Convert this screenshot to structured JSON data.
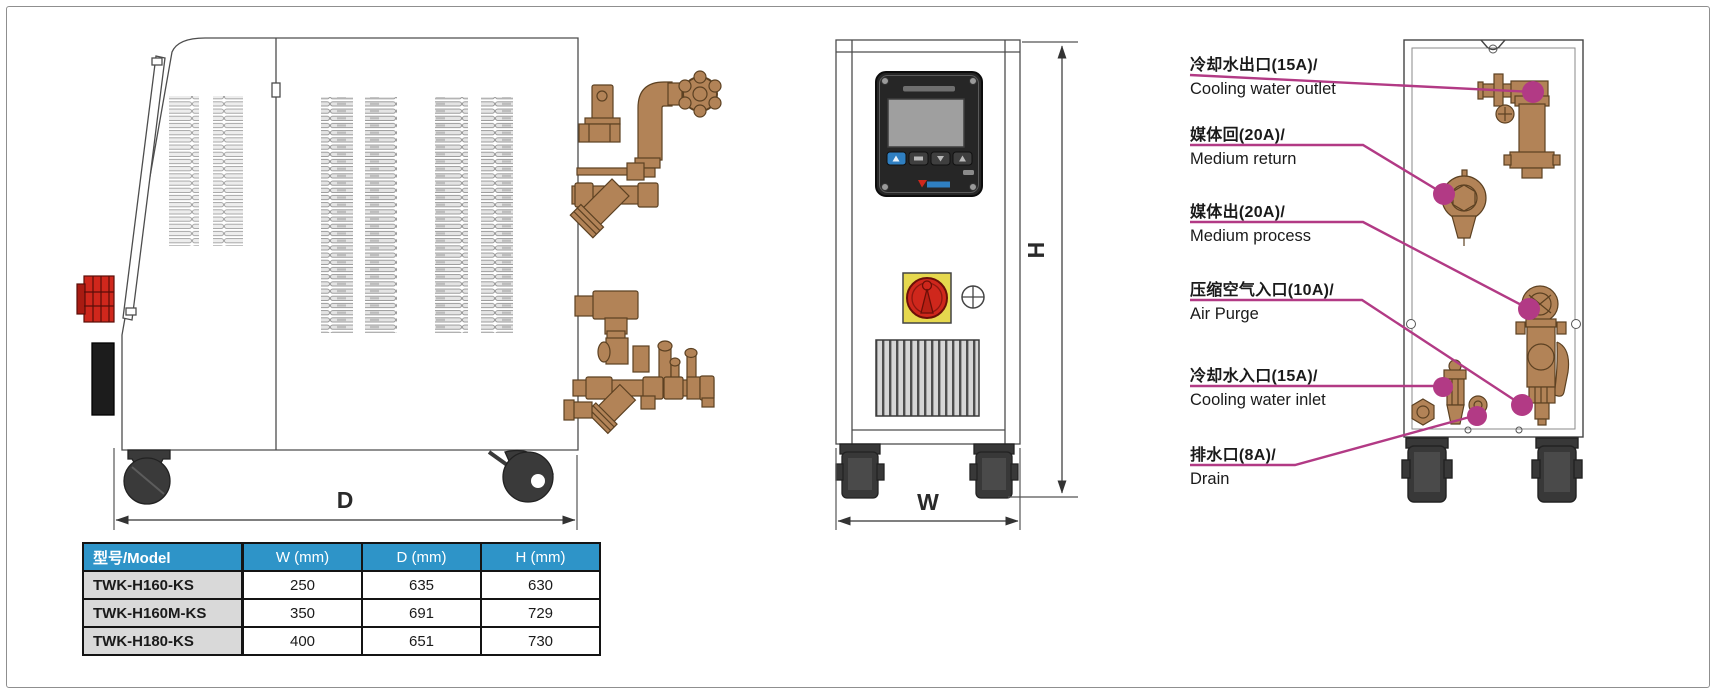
{
  "colors": {
    "accent_magenta": "#b23a85",
    "table_header_bg": "#2e94c8",
    "model_col_bg": "#d9d9d9",
    "brass": "#b28357",
    "switch_red": "#cf271c",
    "switch_panel_yellow": "#e6d84e",
    "wheel_dark": "#3a3a3a"
  },
  "side_view": {
    "dim_label": "D"
  },
  "front_view": {
    "dim_width_label": "W",
    "dim_height_label": "H"
  },
  "port_labels": [
    {
      "zh": "冷却水出口(15A)/",
      "en": "Cooling water outlet"
    },
    {
      "zh": "媒体回(20A)/",
      "en": "Medium return"
    },
    {
      "zh": "媒体出(20A)/",
      "en": "Medium process"
    },
    {
      "zh": "压缩空气入口(10A)/",
      "en": "Air Purge"
    },
    {
      "zh": "冷却水入口(15A)/",
      "en": "Cooling water inlet"
    },
    {
      "zh": "排水口(8A)/",
      "en": "Drain"
    }
  ],
  "dimensions_table": {
    "headers": [
      "型号/Model",
      "W (mm)",
      "D (mm)",
      "H (mm)"
    ],
    "rows": [
      {
        "model": "TWK-H160-KS",
        "w": "250",
        "d": "635",
        "h": "630"
      },
      {
        "model": "TWK-H160M-KS",
        "w": "350",
        "d": "691",
        "h": "729"
      },
      {
        "model": "TWK-H180-KS",
        "w": "400",
        "d": "651",
        "h": "730"
      }
    ]
  }
}
